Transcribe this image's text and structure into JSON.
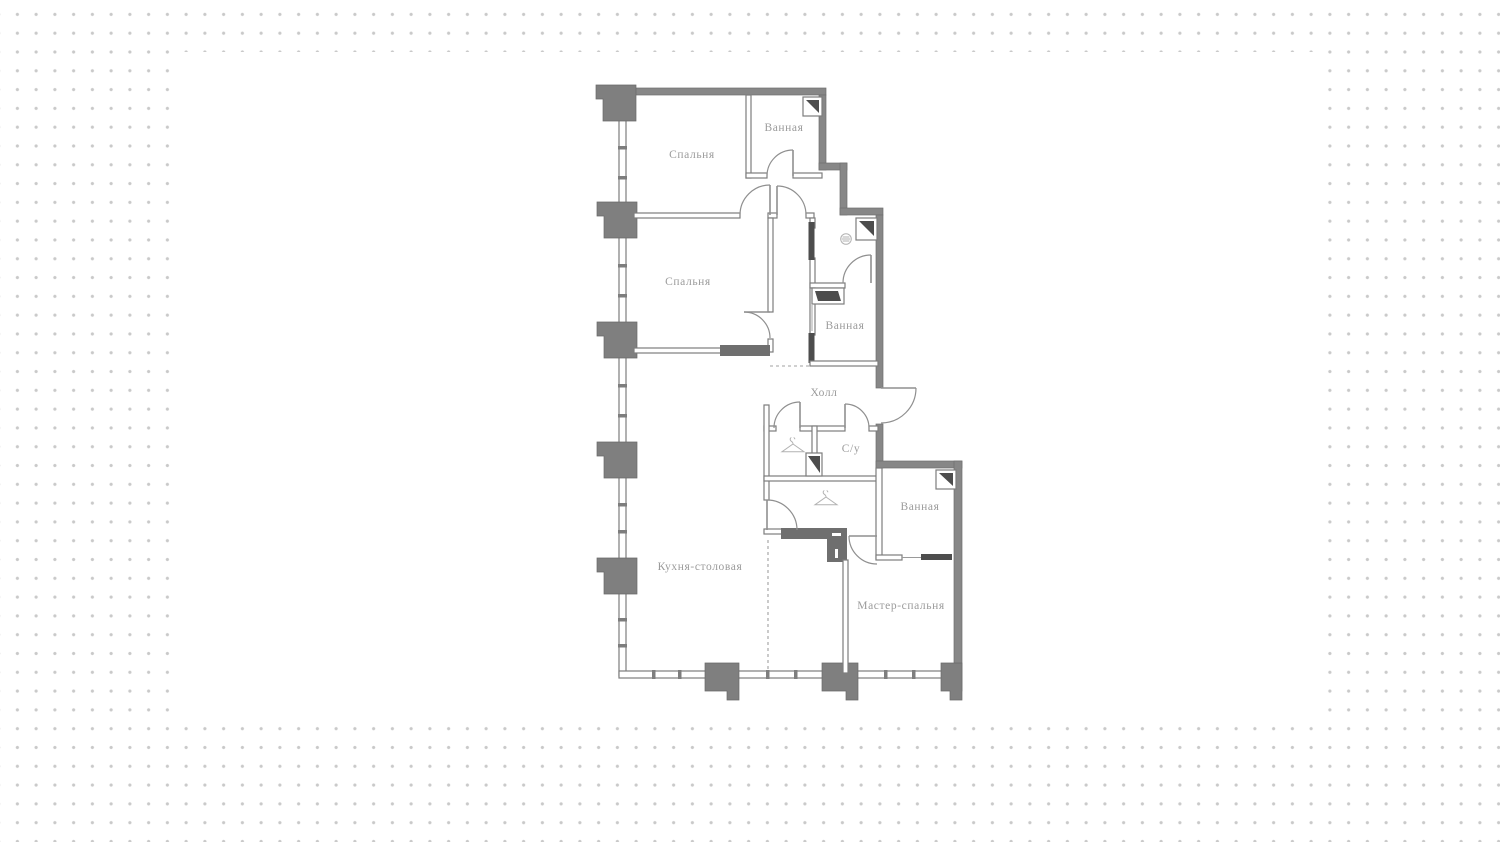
{
  "page": {
    "background": "#ffffff",
    "dot_color": "#c9c9c9",
    "panel_color": "#ffffff"
  },
  "floorplan": {
    "type": "apartment-floor-plan",
    "rooms": [
      {
        "id": "bedroom-1",
        "label": "Спальня",
        "x": 692,
        "y": 158
      },
      {
        "id": "bathroom-1",
        "label": "Ванная",
        "x": 784,
        "y": 131
      },
      {
        "id": "bedroom-2",
        "label": "Спальня",
        "x": 688,
        "y": 285
      },
      {
        "id": "bathroom-2",
        "label": "Ванная",
        "x": 845,
        "y": 329
      },
      {
        "id": "hall",
        "label": "Холл",
        "x": 824,
        "y": 396
      },
      {
        "id": "wc",
        "label": "С/у",
        "x": 851,
        "y": 452
      },
      {
        "id": "bathroom-3",
        "label": "Ванная",
        "x": 920,
        "y": 510
      },
      {
        "id": "kitchen-dining",
        "label": "Кухня-столовая",
        "x": 700,
        "y": 570
      },
      {
        "id": "master-bedroom",
        "label": "Мастер-спальня",
        "x": 901,
        "y": 609
      }
    ],
    "icons": [
      {
        "name": "washing-machine-icon",
        "symbol": "washer",
        "x": 846,
        "y": 239
      },
      {
        "name": "hanger-icon",
        "symbol": "hanger",
        "x": 793,
        "y": 447
      },
      {
        "name": "hanger-icon",
        "symbol": "hanger",
        "x": 826,
        "y": 500
      }
    ],
    "colors": {
      "wall": "#878787",
      "column": "#7f7f7f",
      "wall_dark": "#6f6f6f",
      "door_line": "#8f8f8f",
      "label": "#9b9b9b",
      "icon": "#b2b2b2",
      "dashed": "#a0a0a0"
    }
  }
}
